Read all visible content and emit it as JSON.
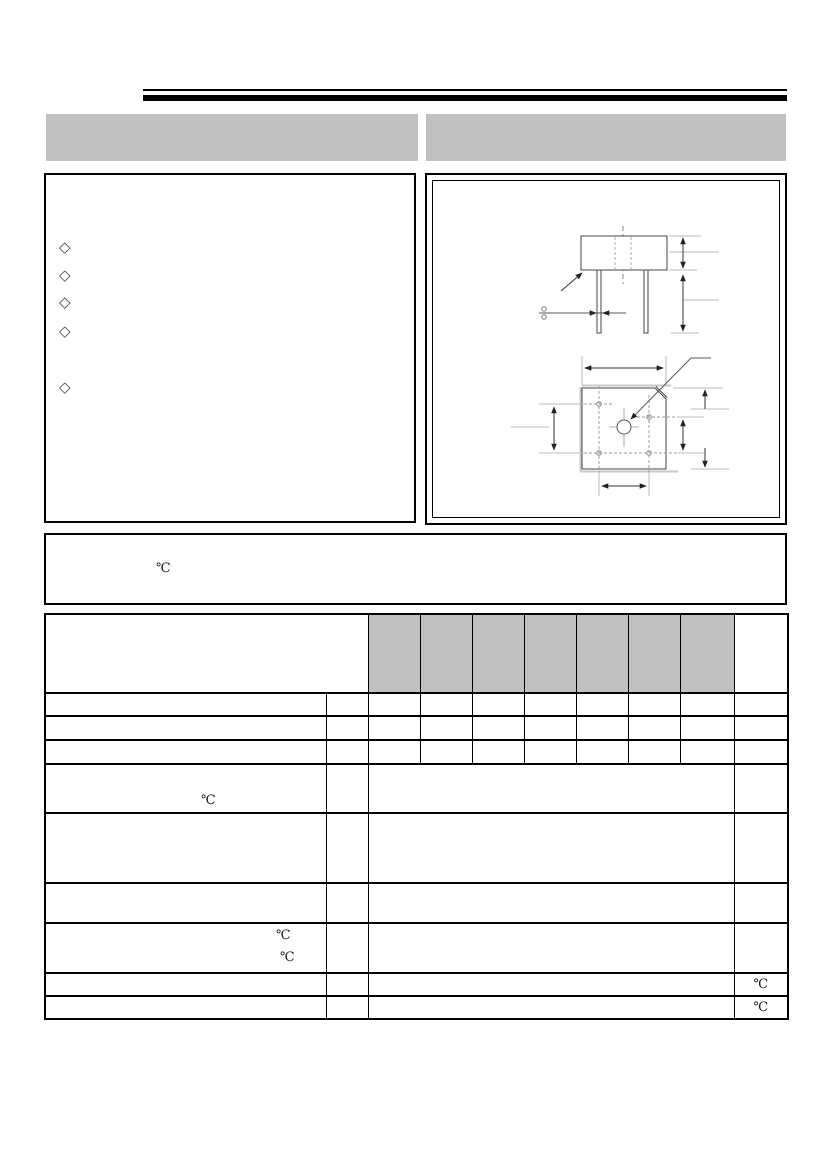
{
  "colors": {
    "accent_gray": "#c0c0c0",
    "line_black": "#000000"
  },
  "features": {
    "bullets": [
      "◇",
      "◇",
      "◇",
      "◇",
      "◇"
    ]
  },
  "note": {
    "temperature_symbol": "℃"
  },
  "table": {
    "header_shaded_columns": 7,
    "r4_temp": "℃",
    "r7_temp_a": "℃",
    "r7_temp_b": "℃",
    "r8_unit": "℃",
    "r9_unit": "℃"
  }
}
